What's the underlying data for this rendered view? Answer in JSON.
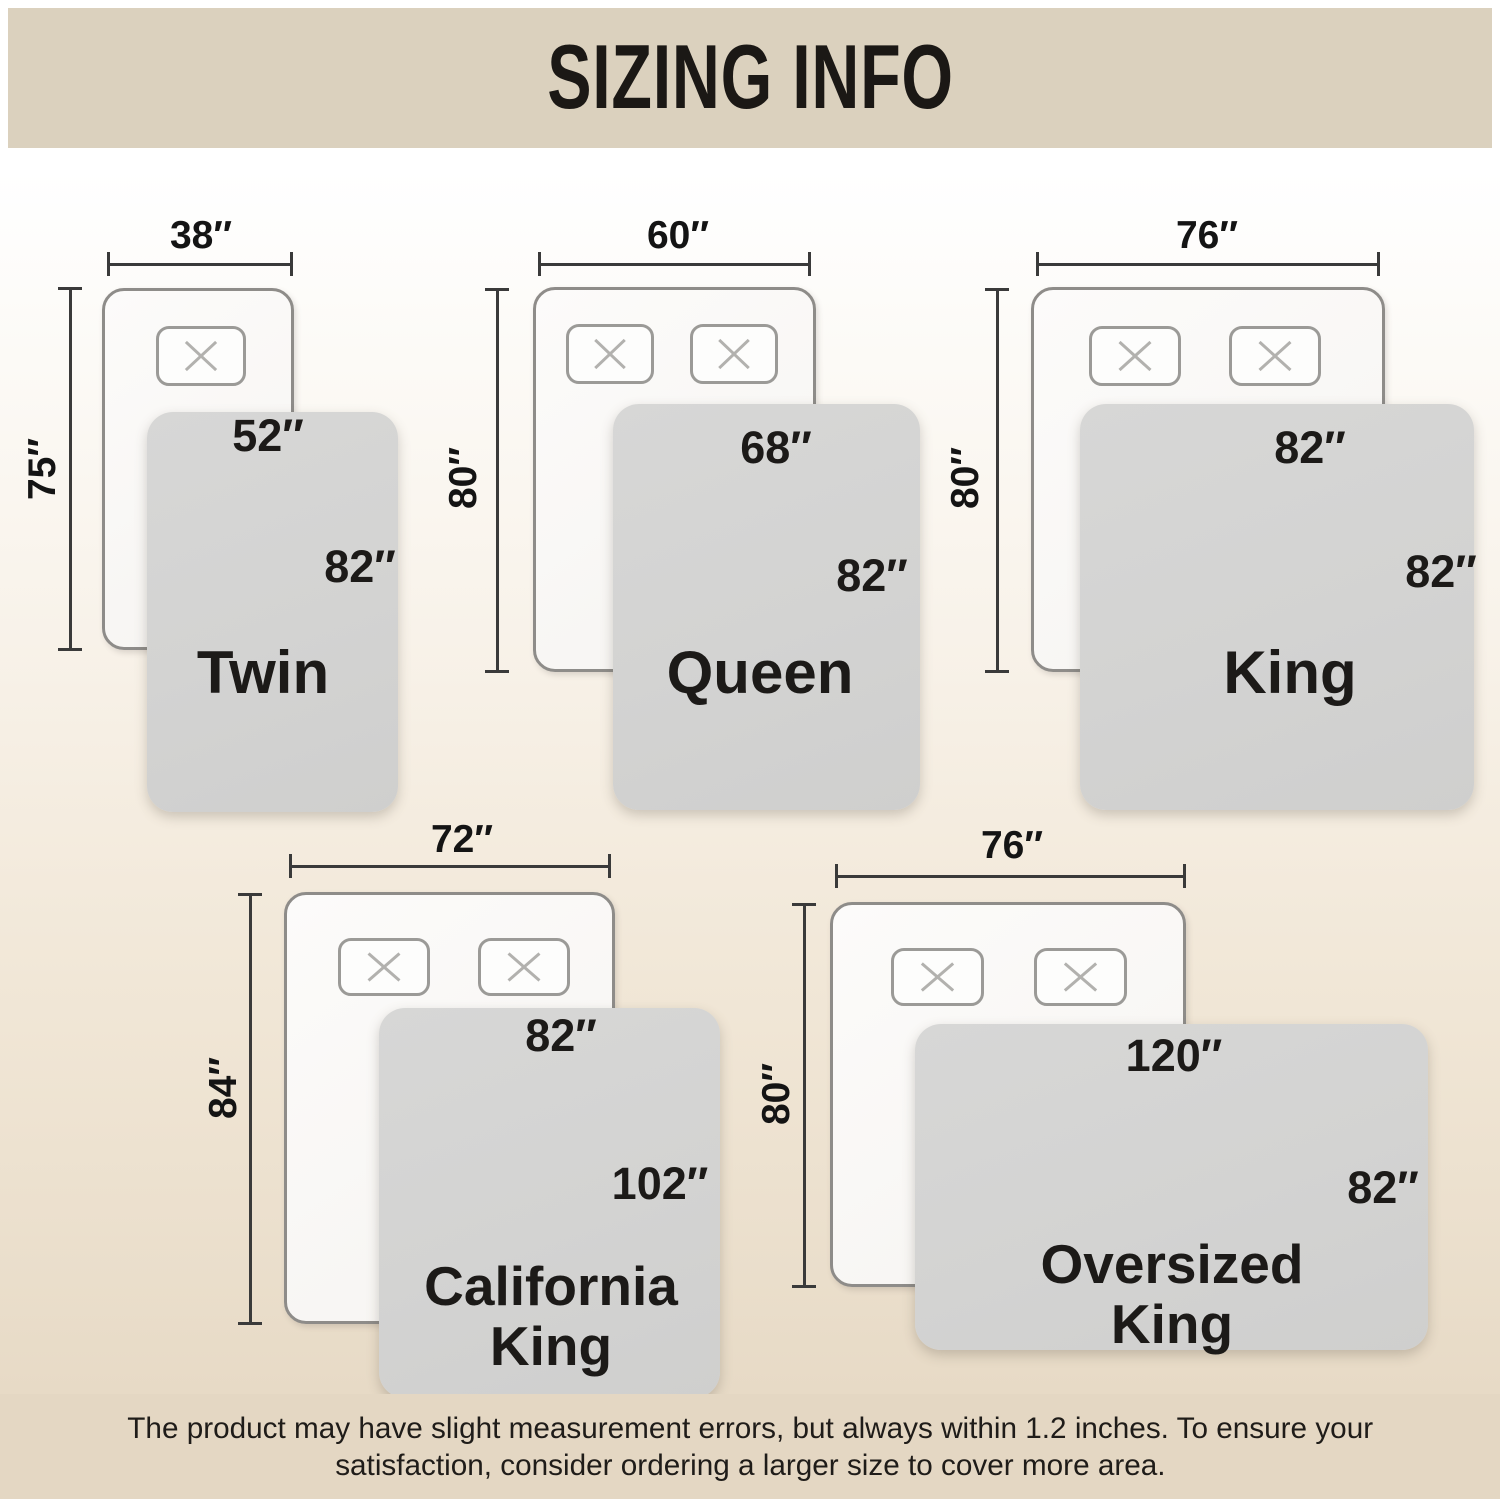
{
  "header": {
    "title": "SIZING INFO"
  },
  "footer": {
    "line1": "The product may have slight measurement errors, but always within 1.2 inches. To ensure your",
    "line2": "satisfaction, consider ordering a larger size to cover more area."
  },
  "colors": {
    "header_bar": "#dbd1be",
    "footer_bar": "#e4d7c3",
    "blanket": "#d3d3d2",
    "mattress_border": "#8e8c89",
    "dim_line": "#3a3a3a",
    "text": "#141414"
  },
  "diagrams": [
    {
      "id": "twin",
      "mattress": {
        "x": 102,
        "y": 288,
        "w": 192,
        "h": 362
      },
      "pillows": [
        {
          "x": 156,
          "y": 326,
          "w": 90,
          "h": 60
        }
      ],
      "h_dim": {
        "label": "38″",
        "line_y": 264,
        "x1": 108,
        "x2": 292,
        "label_cx": 201,
        "label_cy": 236
      },
      "v_dim": {
        "label": "75″",
        "line_x": 70,
        "y1": 288,
        "y2": 650,
        "label_cx": 43,
        "label_cy": 469
      },
      "blanket": {
        "x": 147,
        "y": 412,
        "w": 251,
        "h": 400
      },
      "width_label": {
        "text": "52″",
        "cx": 268,
        "cy": 436
      },
      "height_label": {
        "text": "82″",
        "cx": 360,
        "cy": 567
      },
      "name_label": {
        "lines": [
          "Twin"
        ],
        "cx": 263,
        "top": 642,
        "line_h": 62,
        "font": 60
      }
    },
    {
      "id": "queen",
      "mattress": {
        "x": 533,
        "y": 287,
        "w": 283,
        "h": 385
      },
      "pillows": [
        {
          "x": 566,
          "y": 324,
          "w": 88,
          "h": 60
        },
        {
          "x": 690,
          "y": 324,
          "w": 88,
          "h": 60
        }
      ],
      "h_dim": {
        "label": "60″",
        "line_y": 264,
        "x1": 539,
        "x2": 810,
        "label_cx": 678,
        "label_cy": 236
      },
      "v_dim": {
        "label": "80″",
        "line_x": 497,
        "y1": 289,
        "y2": 672,
        "label_cx": 464,
        "label_cy": 478
      },
      "blanket": {
        "x": 613,
        "y": 404,
        "w": 307,
        "h": 406
      },
      "width_label": {
        "text": "68″",
        "cx": 776,
        "cy": 448
      },
      "height_label": {
        "text": "82″",
        "cx": 872,
        "cy": 576
      },
      "name_label": {
        "lines": [
          "Queen"
        ],
        "cx": 760,
        "top": 642,
        "line_h": 62,
        "font": 60
      }
    },
    {
      "id": "king",
      "mattress": {
        "x": 1031,
        "y": 287,
        "w": 354,
        "h": 385
      },
      "pillows": [
        {
          "x": 1089,
          "y": 326,
          "w": 92,
          "h": 60
        },
        {
          "x": 1229,
          "y": 326,
          "w": 92,
          "h": 60
        }
      ],
      "h_dim": {
        "label": "76″",
        "line_y": 264,
        "x1": 1037,
        "x2": 1379,
        "label_cx": 1207,
        "label_cy": 236
      },
      "v_dim": {
        "label": "80″",
        "line_x": 997,
        "y1": 289,
        "y2": 672,
        "label_cx": 966,
        "label_cy": 478
      },
      "blanket": {
        "x": 1080,
        "y": 404,
        "w": 394,
        "h": 406
      },
      "width_label": {
        "text": "82″",
        "cx": 1310,
        "cy": 448
      },
      "height_label": {
        "text": "82″",
        "cx": 1441,
        "cy": 572
      },
      "name_label": {
        "lines": [
          "King"
        ],
        "cx": 1290,
        "top": 642,
        "line_h": 62,
        "font": 60
      }
    },
    {
      "id": "california-king",
      "mattress": {
        "x": 284,
        "y": 892,
        "w": 331,
        "h": 432
      },
      "pillows": [
        {
          "x": 338,
          "y": 938,
          "w": 92,
          "h": 58
        },
        {
          "x": 478,
          "y": 938,
          "w": 92,
          "h": 58
        }
      ],
      "h_dim": {
        "label": "72″",
        "line_y": 866,
        "x1": 290,
        "x2": 610,
        "label_cx": 462,
        "label_cy": 840
      },
      "v_dim": {
        "label": "84″",
        "line_x": 250,
        "y1": 894,
        "y2": 1324,
        "label_cx": 224,
        "label_cy": 1088
      },
      "blanket": {
        "x": 379,
        "y": 1008,
        "w": 341,
        "h": 390
      },
      "width_label": {
        "text": "82″",
        "cx": 561,
        "cy": 1036
      },
      "height_label": {
        "text": "102″",
        "cx": 660,
        "cy": 1184
      },
      "name_label": {
        "lines": [
          "California",
          "King"
        ],
        "cx": 551,
        "top": 1256,
        "line_h": 60,
        "font": 55
      }
    },
    {
      "id": "oversized-king",
      "mattress": {
        "x": 830,
        "y": 902,
        "w": 356,
        "h": 385
      },
      "pillows": [
        {
          "x": 891,
          "y": 948,
          "w": 93,
          "h": 58
        },
        {
          "x": 1034,
          "y": 948,
          "w": 93,
          "h": 58
        }
      ],
      "h_dim": {
        "label": "76″",
        "line_y": 876,
        "x1": 836,
        "x2": 1185,
        "label_cx": 1012,
        "label_cy": 846
      },
      "v_dim": {
        "label": "80″",
        "line_x": 804,
        "y1": 904,
        "y2": 1287,
        "label_cx": 777,
        "label_cy": 1094
      },
      "blanket": {
        "x": 915,
        "y": 1024,
        "w": 513,
        "h": 326
      },
      "width_label": {
        "text": "120″",
        "cx": 1174,
        "cy": 1056
      },
      "height_label": {
        "text": "82″",
        "cx": 1383,
        "cy": 1188
      },
      "name_label": {
        "lines": [
          "Oversized",
          "King"
        ],
        "cx": 1172,
        "top": 1234,
        "line_h": 60,
        "font": 55
      }
    }
  ]
}
